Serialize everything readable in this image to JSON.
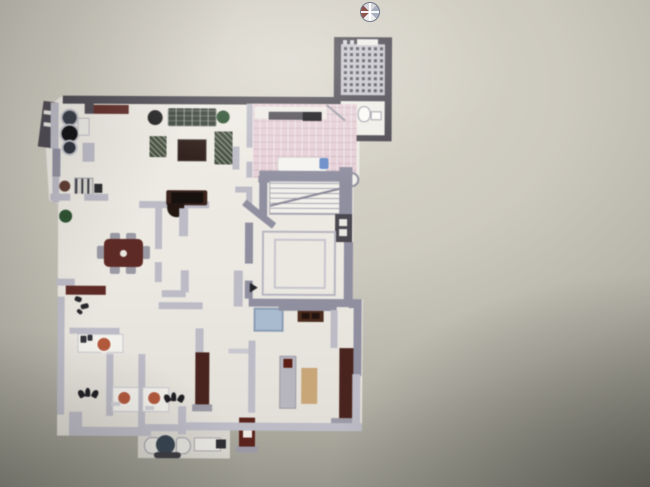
{
  "scene": {
    "kind": "photograph-of-architectural-floor-plan",
    "visible_text": "none",
    "orientation_marker": "compass-rose top center-right"
  },
  "colors": {
    "photo_bg_light": "#d9d5ca",
    "photo_bg_mid": "#b3b1a6",
    "photo_bg_dark": "#716f66",
    "floor": "#ece9e2",
    "wall_dark": "#4b4850",
    "wall_medium": "#908fa0",
    "wall_light": "#bcbbc6",
    "tile_pink": "#e5cfd6",
    "tile_pink_line": "#d3b9c3",
    "wood_dark_red": "#5e2a25",
    "wood_brown_dark": "#49241e",
    "table_black": "#17120f",
    "sofa_green": "#39423a",
    "plant_green": "#2c5130",
    "plant_black": "#1e1e1e",
    "sink_orange": "#b2593c",
    "shower_blue": "#a9bccf",
    "island_blue": "#6b8cc9",
    "tan_wood": "#c8a678",
    "chair_gray": "#9a99a4",
    "base_gray": "#9b9aa5",
    "compass_red": "#76352c",
    "compass_blue": "#9aa2b4"
  },
  "rooms": [
    {
      "name": "entry-stair-tower",
      "features": [
        "steel-grate-stair",
        "window-slot"
      ]
    },
    {
      "name": "upper-bathroom",
      "features": [
        "toilet",
        "sink",
        "door-swing"
      ]
    },
    {
      "name": "kitchen-alcove",
      "features": [
        "cooktop-circles",
        "red-counter",
        "bay-window"
      ]
    },
    {
      "name": "living-room",
      "features": [
        "sofa",
        "coffee-table",
        "black-planter",
        "green-plants",
        "armchairs",
        "tv-desk"
      ]
    },
    {
      "name": "pink-tiled-kitchen",
      "features": [
        "tile-floor",
        "counter-dark",
        "counter-black",
        "island-with-blue-sink"
      ]
    },
    {
      "name": "interior-staircase",
      "features": [
        "steps",
        "diagonal-stringer",
        "newel-circle"
      ]
    },
    {
      "name": "master-room",
      "features": [
        "large-square-bed-outline",
        "door-swing-arrow",
        "wall-niche-windows"
      ]
    },
    {
      "name": "dining-room",
      "features": [
        "dining-table",
        "six-chairs",
        "sideboard",
        "plant",
        "radiator"
      ]
    },
    {
      "name": "bathrooms",
      "features": [
        "vanity-sink-1",
        "vanity-sink-2",
        "vanity-sink-3",
        "shower-tray"
      ]
    },
    {
      "name": "bedrooms",
      "features": [
        "wardrobe-left",
        "wardrobe-right",
        "gray-cabinet",
        "tan-door",
        "dresser"
      ]
    },
    {
      "name": "terrace",
      "features": [
        "round-table",
        "curved-chairs",
        "bench",
        "grill"
      ]
    }
  ]
}
